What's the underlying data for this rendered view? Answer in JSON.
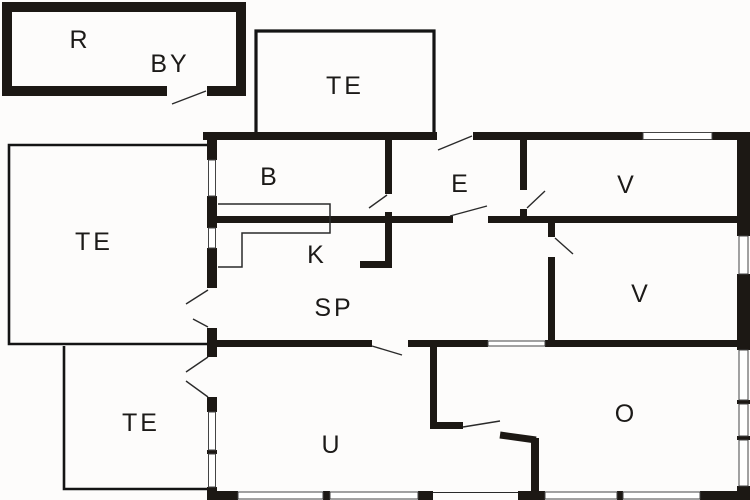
{
  "plan": {
    "title": "floor-plan",
    "background_color": "#fdfcfb",
    "wall_color": "#1c1814",
    "label_color": "#1c1a18",
    "rooms": [
      {
        "id": "r",
        "label": "R"
      },
      {
        "id": "by",
        "label": "BY"
      },
      {
        "id": "te-top",
        "label": "TE"
      },
      {
        "id": "b",
        "label": "B"
      },
      {
        "id": "e",
        "label": "E"
      },
      {
        "id": "v-upper",
        "label": "V"
      },
      {
        "id": "te-left",
        "label": "TE"
      },
      {
        "id": "k",
        "label": "K"
      },
      {
        "id": "sp",
        "label": "SP"
      },
      {
        "id": "v-middle",
        "label": "V"
      },
      {
        "id": "te-lower",
        "label": "TE"
      },
      {
        "id": "u",
        "label": "U"
      },
      {
        "id": "o",
        "label": "O"
      }
    ]
  }
}
